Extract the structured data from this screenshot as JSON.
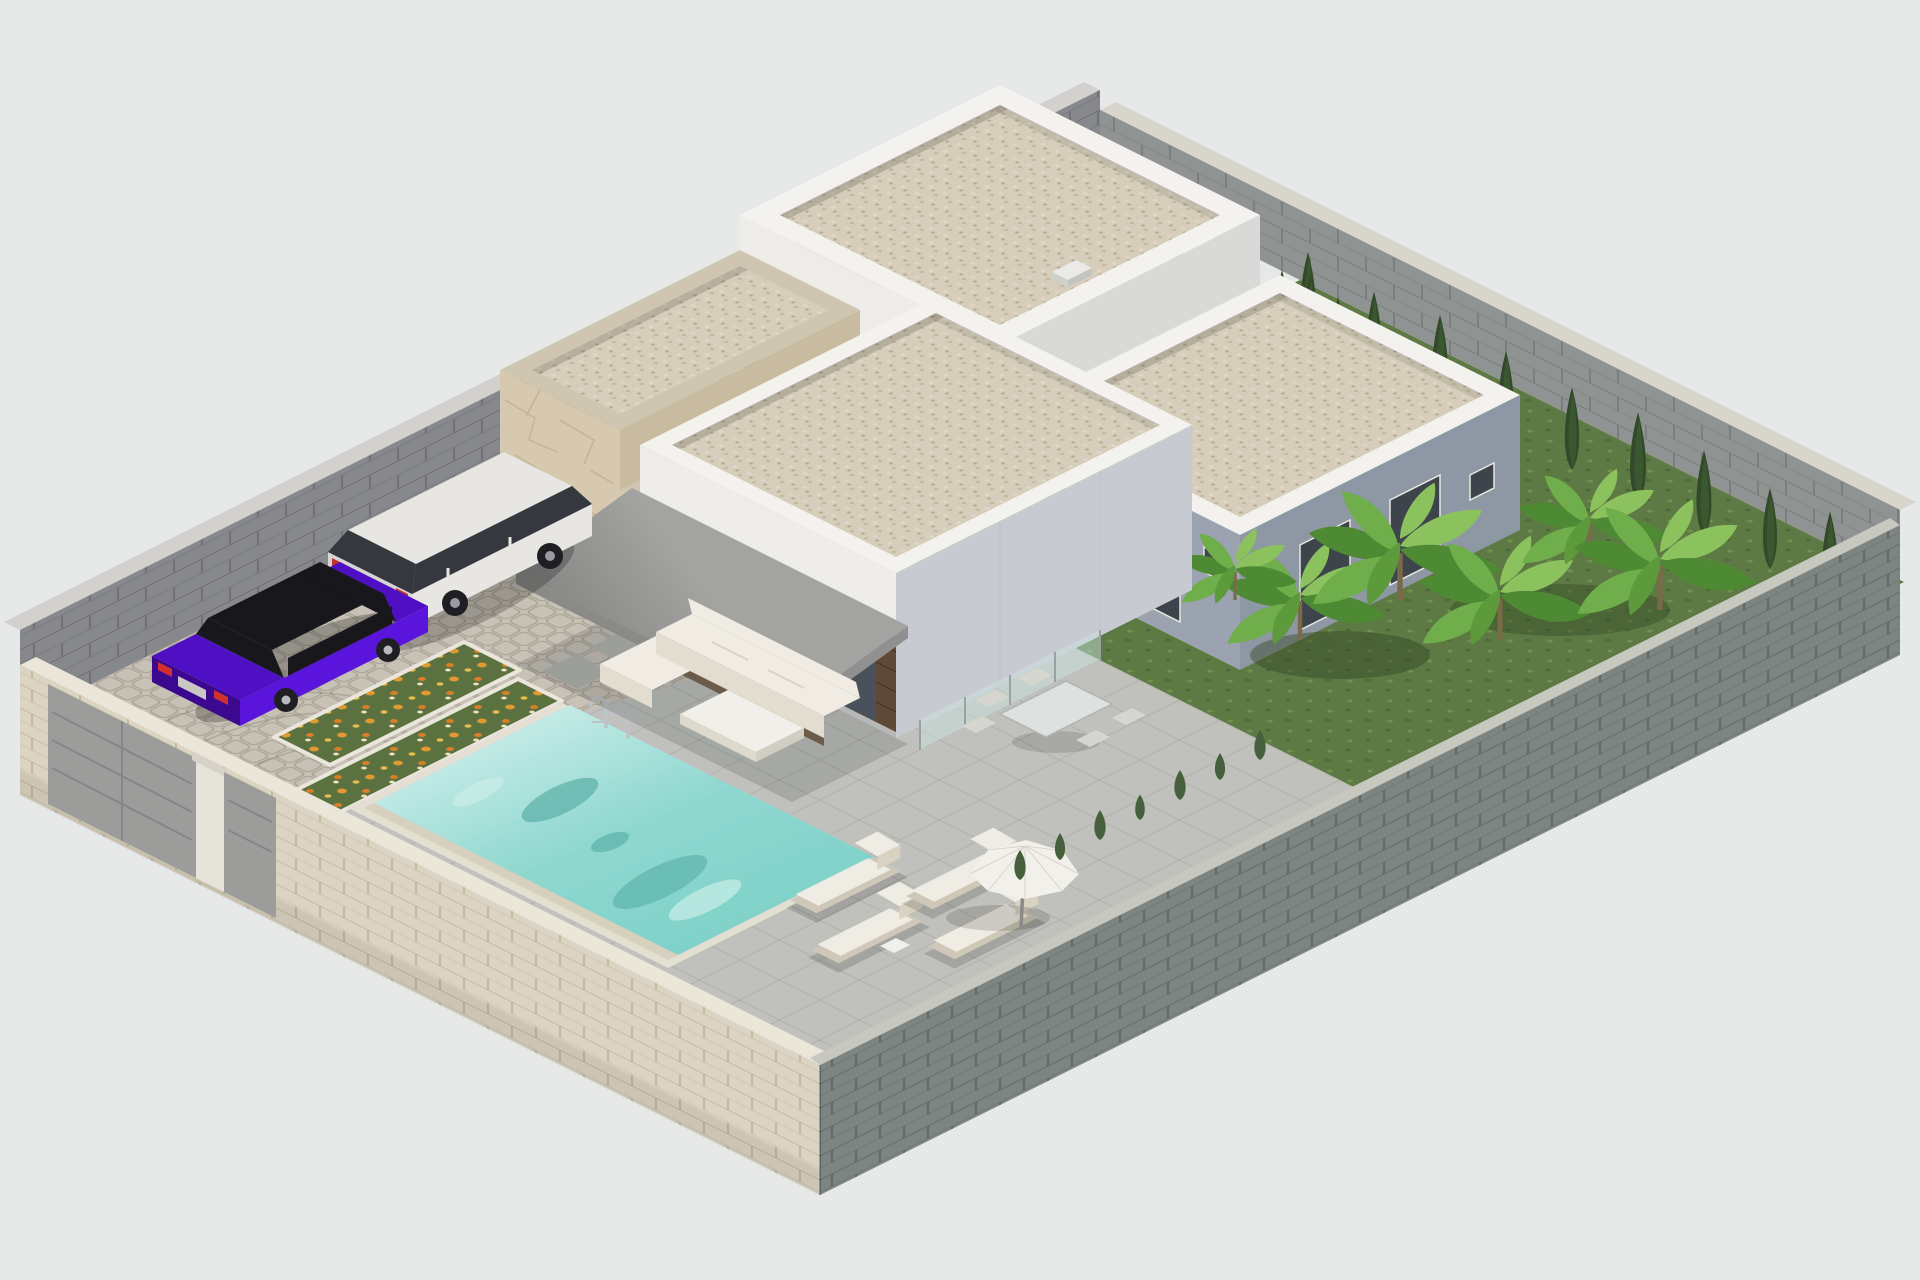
{
  "scene": {
    "type": "architectural-3d-render",
    "view": "isometric-aerial",
    "subject": "modern single-storey villa plot with swimming pool, parking court and garden",
    "inventory": {
      "buildings": 3,
      "stone_clad_structures": 2,
      "cars": [
        {
          "name": "purple-sedan",
          "body_color": "#5a14dc"
        },
        {
          "name": "white-suv",
          "body_color": "#e8e6e2"
        }
      ],
      "swimming_pools": 1,
      "pool_ladders": 1,
      "sun_loungers": 4,
      "parasols": 1,
      "outdoor_sofas": 1,
      "coffee_tables": 1,
      "dining_tables": 1,
      "dining_chairs": 5,
      "glass_balustrade_panels": 4,
      "gates": 2,
      "flower_beds": 2,
      "stepping_stones": 4,
      "cypress_trees": 17,
      "banana_plants": 5,
      "shrubs": 7
    }
  },
  "colors": {
    "background": "#e7e8e8",
    "wall_back_face": "#87888c",
    "wall_back_cap": "#d2d1ce",
    "wall_right_face": "#8f9492",
    "wall_right_cap": "#d8d5cc",
    "wall_front_left_face": "#dcd4c2",
    "wall_front_left_cap": "#eae6da",
    "wall_front_right_face": "#7d8583",
    "wall_front_right_cap": "#c8c7c0",
    "gate_panel": "#9c9c9a",
    "gate_pillar": "#e6e3db",
    "parking_cobble": "#c8c2b6",
    "gravel_court": "#ccc7ba",
    "terrace_tile": "#c0c1bc",
    "grass": "#5e7a44",
    "flower_bed": "#5c7140",
    "flower_orange": "#e0952f",
    "curb": "#eae6db",
    "pool_coping": "#e3dfd3",
    "pool_wall": "#d7d0bf",
    "water_deep": "#7fd2c9",
    "water_shadow": "#47a29a",
    "ladder": "#c0c3c5",
    "building_white": "#eeece8",
    "building_white_shade": "#d9dad8",
    "parapet": "#f4f2ef",
    "roof_gravel": "#d6cdbb",
    "facade_shadow_sw": "#9aa3af",
    "facade_shadow_se": "#8e98a4",
    "window_glass": "#3d444c",
    "villa_side": "#c7cbd1",
    "villa_glass": "#49515a",
    "wood_panel": "#5f4a38",
    "awning_top": "#a3a3a1",
    "awning_fascia": "#8a8a88",
    "stone_face": "#d6c9b0",
    "stone_side": "#c9bb9f",
    "stone_top": "#cfc6b2",
    "cypress": "#33492a",
    "shrub": "#45603a",
    "banana_green": "#6fae4a",
    "banana_dark": "#4e8a33",
    "banana_light": "#8cc25e",
    "suv_body": "#e8e6e2",
    "suv_glass": "#35393f",
    "sedan_body": "#5a14dc",
    "sedan_dark": "#3c0890",
    "sedan_glass": "#17171c",
    "lounger": "#efece4",
    "umbrella": "#f2f0ea",
    "sofa_cushion": "#f0ece3",
    "sofa_base": "#6b5b49",
    "table_top": "#f1efe9",
    "dining_top": "#dde2e1",
    "chair": "#d7d5cf"
  }
}
